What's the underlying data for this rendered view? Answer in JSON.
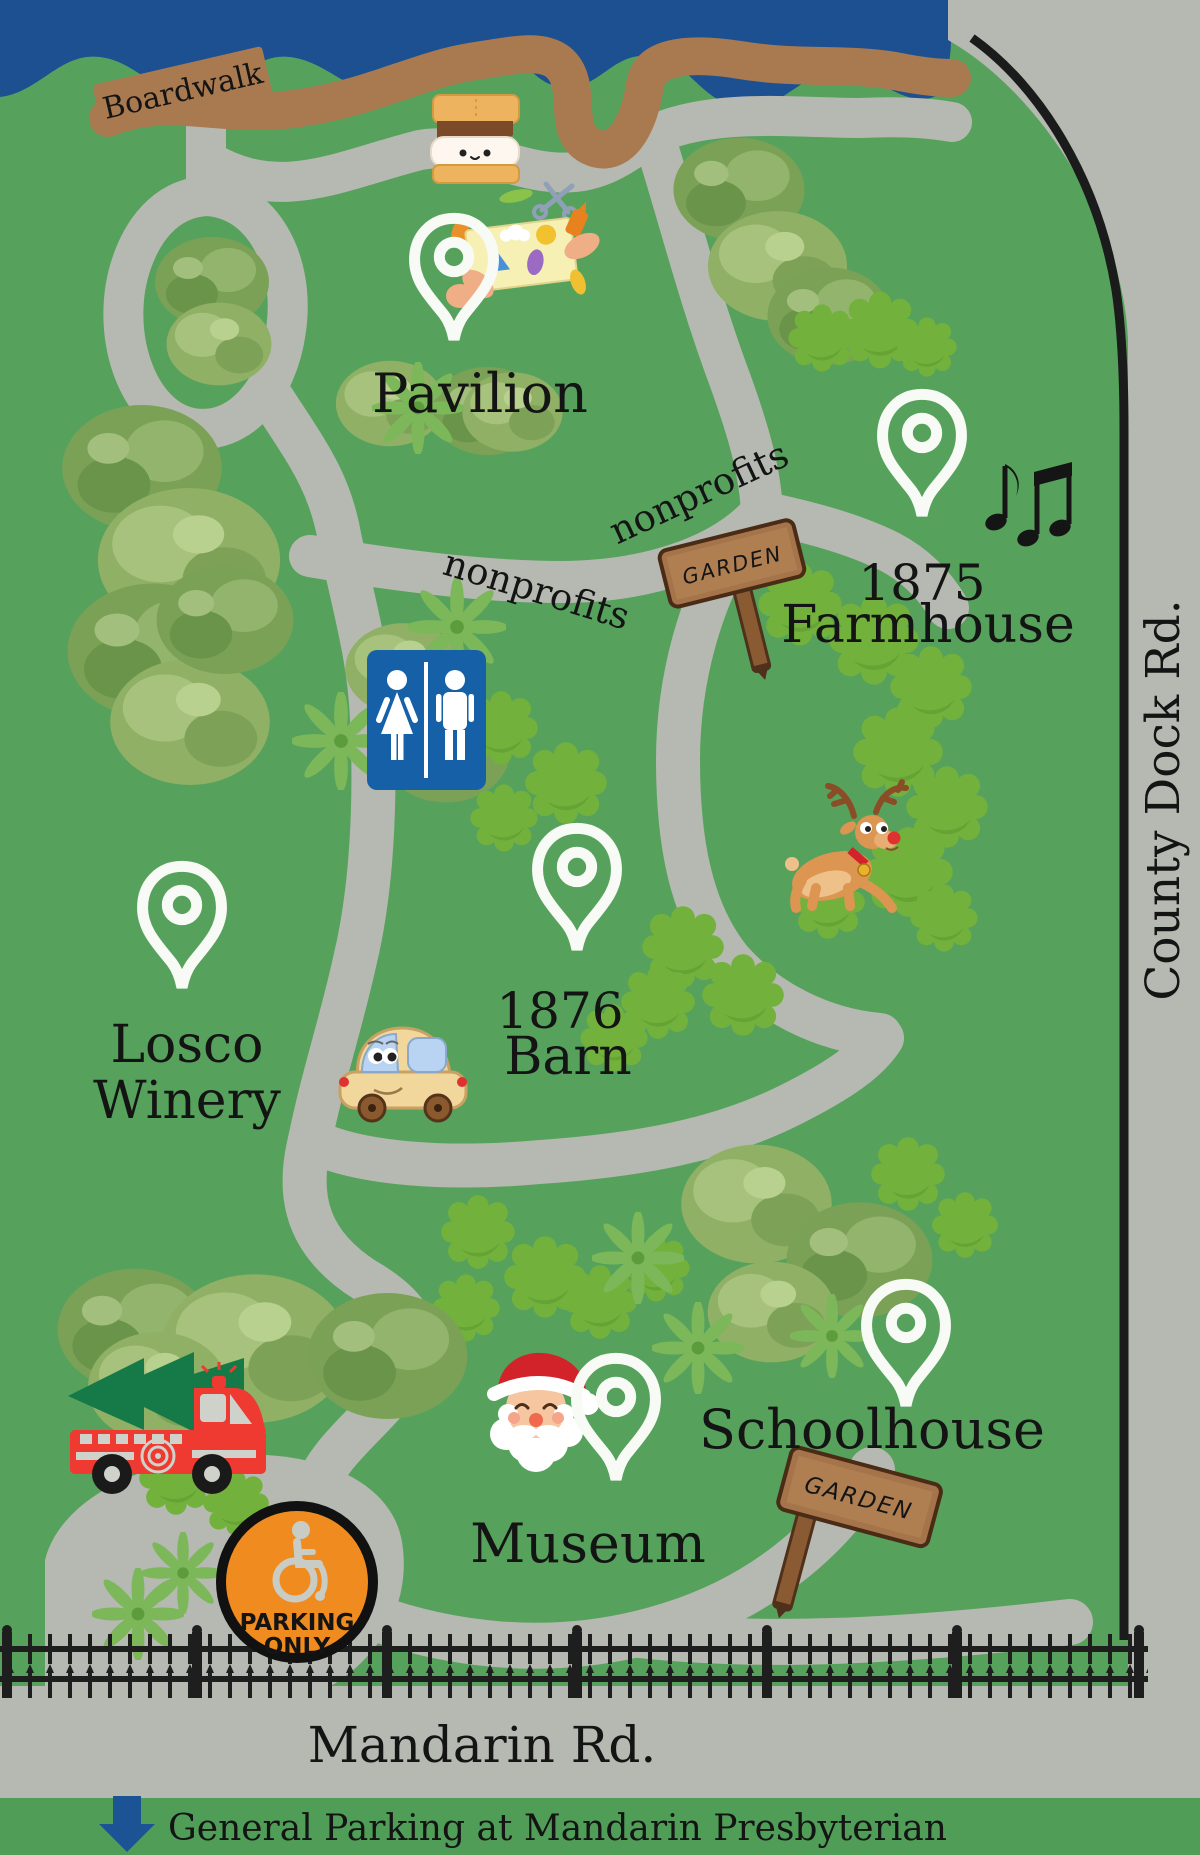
{
  "labels": {
    "boardwalk": "Boardwalk",
    "pavilion": "Pavilion",
    "nonprofits_upper": "nonprofits",
    "nonprofits_lower": "nonprofits",
    "farmhouse_year": "1875",
    "farmhouse_name": "Farmhouse",
    "winery_line1": "Losco",
    "winery_line2": "Winery",
    "barn_year": "1876",
    "barn_name": "Barn",
    "museum": "Museum",
    "schoolhouse": "Schoolhouse",
    "county_dock_rd": "County Dock Rd.",
    "mandarin_rd": "Mandarin Rd.",
    "garden_sign_1": "GARDEN",
    "garden_sign_2": "GARDEN",
    "parking_line1": "PARKING",
    "parking_line2": "ONLY",
    "footer": "General Parking at Mandarin Presbyterian"
  },
  "icons": {
    "location_pin_icon": "white map pin",
    "smore_icon": "s'more",
    "crafts_icon": "arts and crafts hands with scissors",
    "music_notes_icon": "music notes",
    "restroom_icon": "restroom man and woman sign",
    "garden_sign_icon": "wooden garden sign",
    "reindeer_icon": "reindeer",
    "car_icon": "cartoon car",
    "fire_truck_icon": "fire truck carrying christmas tree",
    "santa_icon": "santa claus",
    "wheelchair_icon": "accessible parking wheelchair",
    "down_arrow_icon": "blue down arrow"
  },
  "colors": {
    "grass": "#56a25c",
    "water": "#1c5091",
    "boardwalk": "#a97a50",
    "path": "#b6b9b1",
    "footer_bar": "#4f9d57",
    "restroom_blue": "#1660a8",
    "parking_orange": "#ef8b1f",
    "fire_truck_red": "#ee3a31",
    "pin_white": "#f7faf5",
    "fence_black": "#1e1e1e"
  }
}
